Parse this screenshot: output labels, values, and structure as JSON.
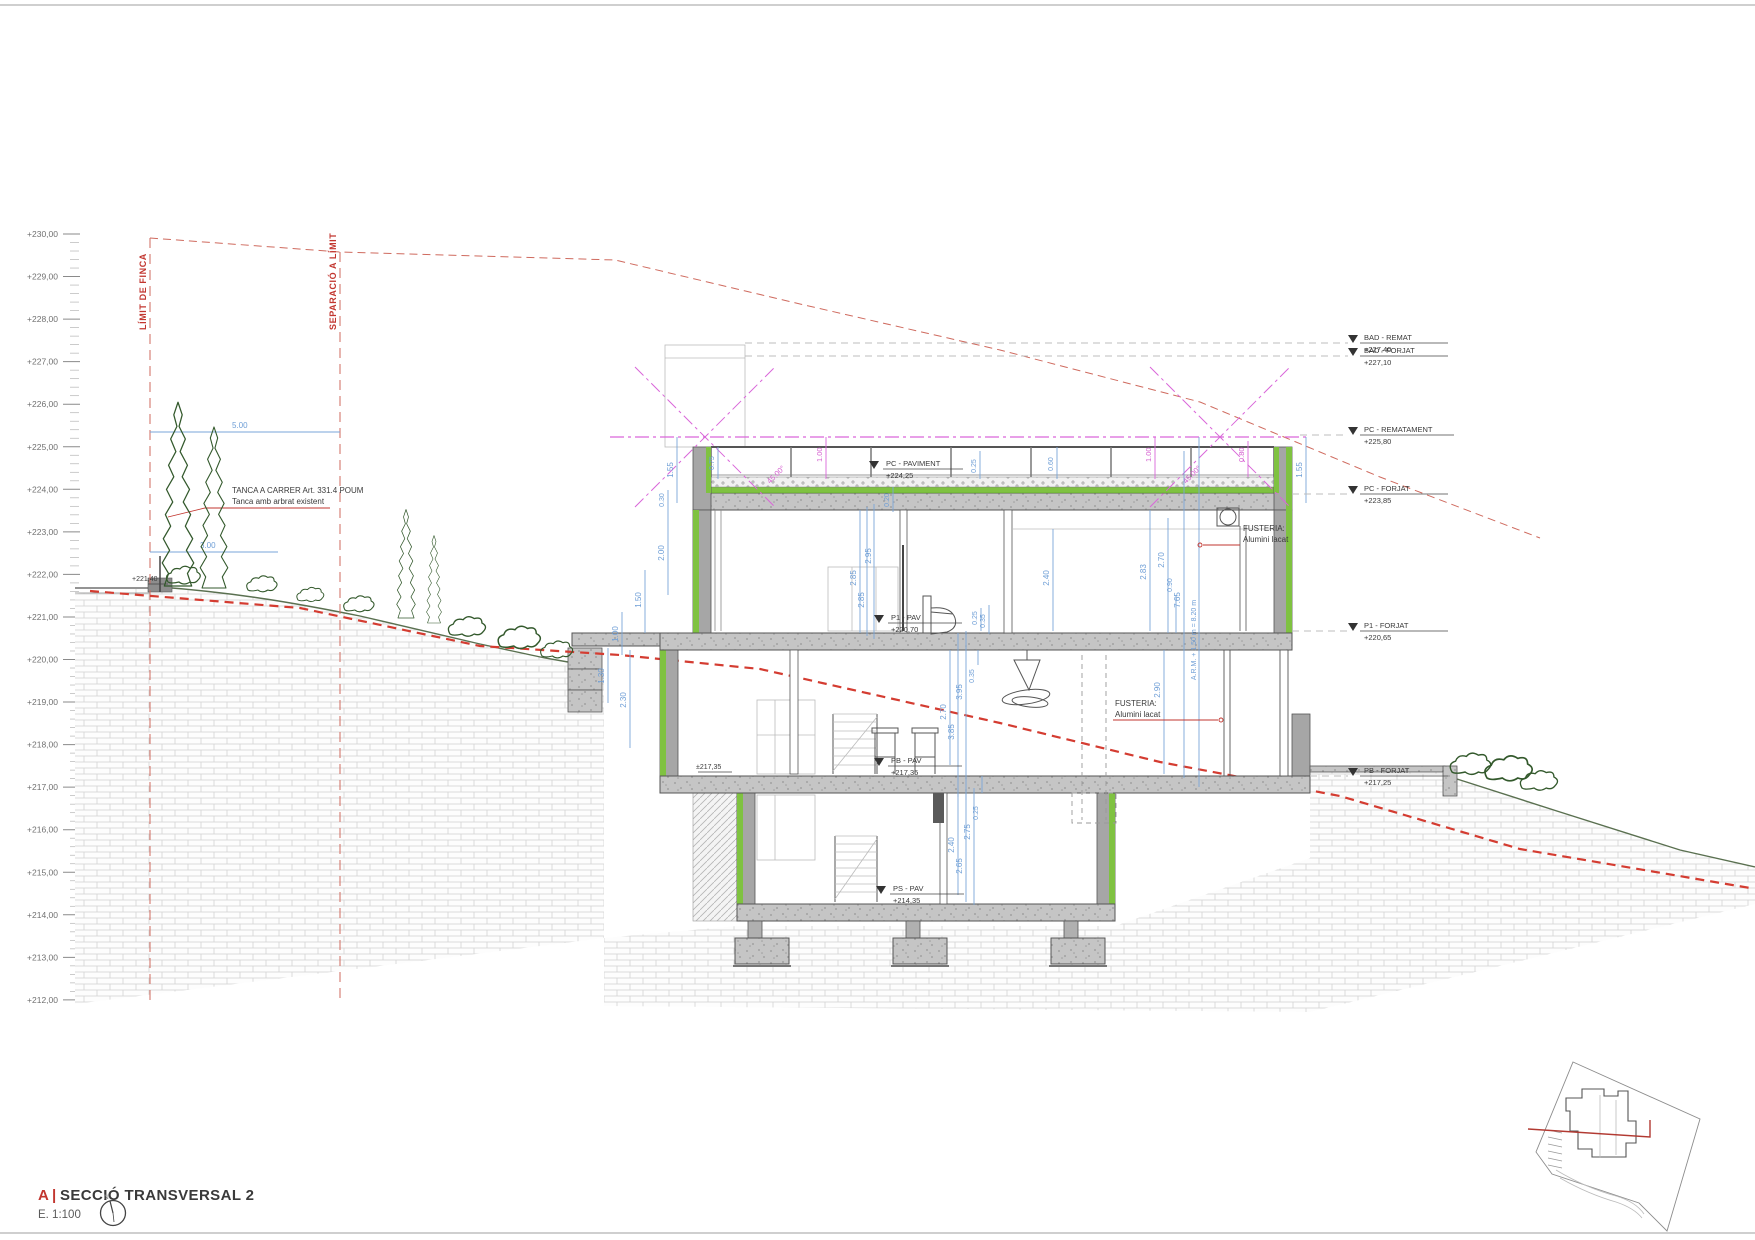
{
  "scale": {
    "labels": [
      "+230,00",
      "+229,00",
      "+228,00",
      "+227,00",
      "+226,00",
      "+225,00",
      "+224,00",
      "+223,00",
      "+222,00",
      "+221,00",
      "+220,00",
      "+219,00",
      "+218,00",
      "+217,00",
      "+216,00",
      "+215,00",
      "+214,00",
      "+213,00",
      "+212,00"
    ]
  },
  "boundaries": {
    "limit": "LÍMIT DE FINCA",
    "separacio": "SEPARACIÓ A LÍMIT"
  },
  "notes": {
    "fence1": "TANCA A CARRER Art. 331.4 POUM",
    "fence2": "Tanca amb arbrat existent",
    "street_level": "+221,40",
    "grade_level": "±217,35",
    "fusteria1a": "FUSTERIA:",
    "fusteria1b": "Alumini lacat",
    "fusteria2a": "FUSTERIA:",
    "fusteria2b": "Alumini lacat"
  },
  "levels_right": [
    {
      "label": "BAD - REMAT",
      "value": "+227,40"
    },
    {
      "label": "BAD - FORJAT",
      "value": "+227,10"
    },
    {
      "label": "PC - REMATAMENT",
      "value": "+225,80"
    },
    {
      "label": "PC - FORJAT",
      "value": "+223,85"
    },
    {
      "label": "P1 - FORJAT",
      "value": "+220,65"
    },
    {
      "label": "PB - FORJAT",
      "value": "+217,25"
    }
  ],
  "levels_floor": [
    {
      "label": "PC - PAVIMENT",
      "value": "+224,25"
    },
    {
      "label": "P1 - PAV",
      "value": "+220,70"
    },
    {
      "label": "PB - PAV",
      "value": "+217,35"
    },
    {
      "label": "PS - PAV",
      "value": "+214,35"
    }
  ],
  "dims": {
    "h500": "5.00",
    "h300": "3.00",
    "v155": "1.55",
    "v075": "0.75",
    "v030": "0.30",
    "v200": "2.00",
    "v150": "1.50",
    "v100": "1.00",
    "v130": "1.30",
    "v230": "2.30",
    "v285": "2.85",
    "v295": "2.95",
    "v025": "0.25",
    "v035": "0.35",
    "v020": "0.20",
    "v060": "0.60",
    "v240": "2.40",
    "v283": "2.83",
    "v270": "2.70",
    "v385": "3.85",
    "v395": "3.95",
    "v265": "2.65",
    "v275": "2.75",
    "v090": "0.90",
    "v765": "7.65",
    "v290": "2.90",
    "v080": "0.80",
    "angle": "45.00°",
    "arm": "A.R.M. + 1.50 m = 8.20 m"
  },
  "title": {
    "tag": "A",
    "sep": "|",
    "name": "SECCIÓ TRANSVERSAL 2",
    "scale": "E. 1:100",
    "north": "N"
  },
  "colors": {
    "insulation_green": "#7fc241",
    "boundary_red": "#cf6a5e",
    "terrain_red": "#d43c31",
    "regulation_pink": "#d966d9",
    "dimension_blue": "#7aa6d8",
    "accent_red": "#c2362f"
  }
}
